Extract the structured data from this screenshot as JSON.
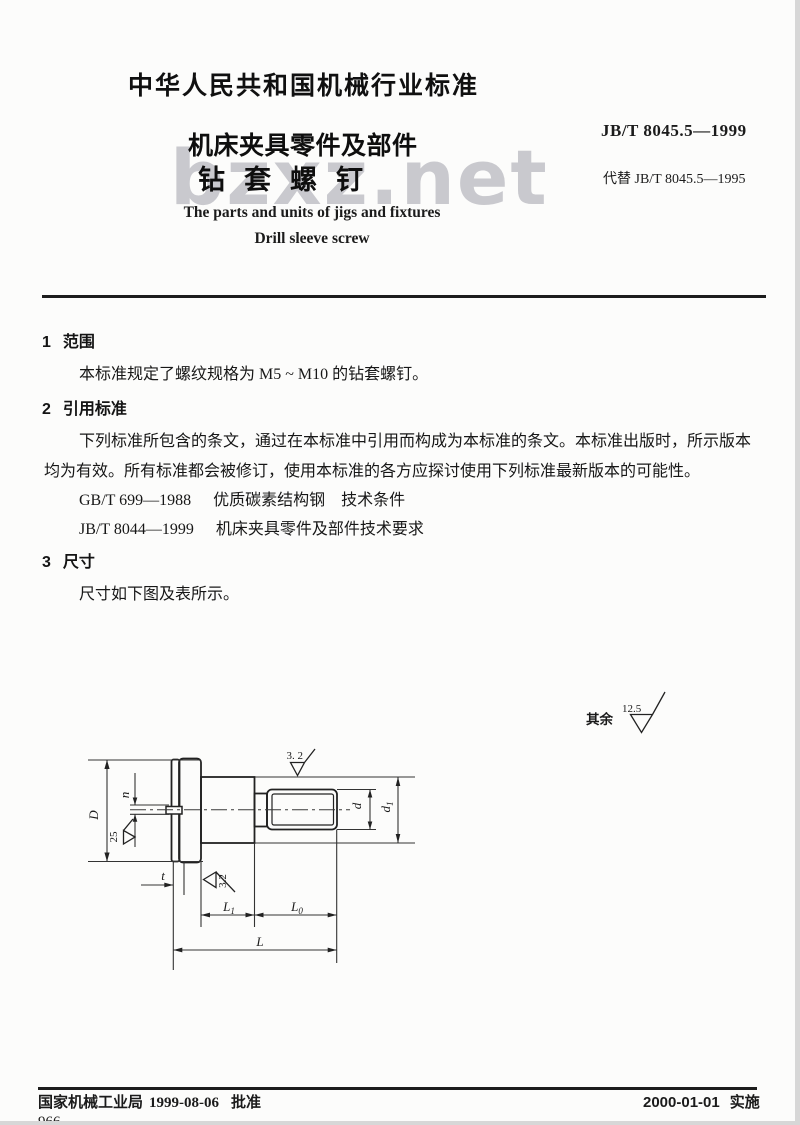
{
  "header": {
    "standard_type": "中华人民共和国机械行业标准",
    "standard_number": "JB/T 8045.5—1999",
    "replaces": "代替 JB/T 8045.5—1995",
    "title_line1": "机床夹具零件及部件",
    "title_line2": "钻套螺钉",
    "title_en_line1": "The parts and units of jigs and fixtures",
    "title_en_line2": "Drill sleeve screw",
    "watermark": "bzxz.net"
  },
  "sections": {
    "s1": {
      "number": "1",
      "heading": "范围",
      "body": "本标准规定了螺纹规格为 M5 ~ M10 的钻套螺钉。"
    },
    "s2": {
      "number": "2",
      "heading": "引用标准",
      "body_line1": "下列标准所包含的条文，通过在本标准中引用而构成为本标准的条文。本标准出版时，所示版本",
      "body_line2": "均为有效。所有标准都会被修订，使用本标准的各方应探讨使用下列标准最新版本的可能性。",
      "references": [
        {
          "code": "GB/T 699—1988",
          "title": "优质碳素结构钢　技术条件"
        },
        {
          "code": "JB/T 8044—1999",
          "title": "机床夹具零件及部件技术要求"
        }
      ]
    },
    "s3": {
      "number": "3",
      "heading": "尺寸",
      "body": "尺寸如下图及表所示。"
    }
  },
  "figure": {
    "general_roughness_prefix": "其余",
    "general_roughness_value": "12.5",
    "roughness_head": "25",
    "roughness_shank": "3. 2",
    "roughness_slot": "3.2",
    "dim_D": "D",
    "dim_n": "n",
    "dim_t": "t",
    "dim_d": "d",
    "dim_d1_base": "d",
    "dim_d1_sub": "1",
    "dim_L1_base": "L",
    "dim_L1_sub": "1",
    "dim_L0_base": "L",
    "dim_L0_sub": "0",
    "dim_L": "L"
  },
  "footer": {
    "approval_agency": "国家机械工业局",
    "approval_date": "1999-08-06",
    "approval_word": "批准",
    "implement_date": "2000-01-01",
    "implement_word": "实施",
    "page_number_partial": "966"
  }
}
